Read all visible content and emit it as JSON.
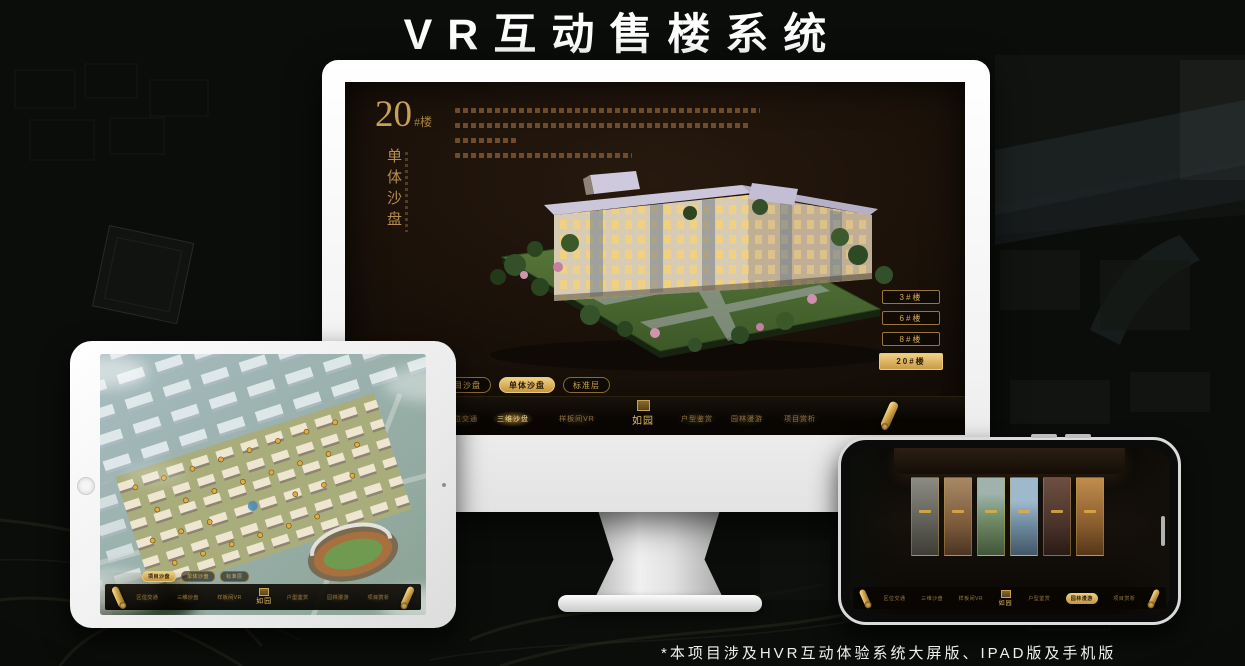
{
  "page": {
    "title": "VR互动售楼系统",
    "footnote": "*本项目涉及HVR互动体验系统大屏版、IPAD版及手机版"
  },
  "brand": {
    "logo_text": "如园"
  },
  "nav": {
    "items": [
      {
        "label": "区位交通"
      },
      {
        "label": "三维沙盘"
      },
      {
        "label": "样板间VR"
      },
      {
        "label": "户型鉴赏"
      },
      {
        "label": "园林漫游"
      },
      {
        "label": "项目赏析"
      }
    ]
  },
  "sub_tabs": [
    {
      "label": "项目沙盘"
    },
    {
      "label": "单体沙盘"
    },
    {
      "label": "标准层"
    }
  ],
  "desktop": {
    "unit_number": "20",
    "unit_suffix": "#楼",
    "unit_subtitle": "单体沙盘",
    "floor_buttons": [
      {
        "label": "3#楼"
      },
      {
        "label": "6#楼"
      },
      {
        "label": "8#楼"
      },
      {
        "label": "20#楼"
      }
    ],
    "selected_floor": "20#楼",
    "selected_sub_tab": "单体沙盘",
    "selected_nav": "三维沙盘"
  },
  "tablet": {
    "selected_sub_tab": "项目沙盘"
  },
  "phone": {
    "selected_nav": "园林漫游"
  },
  "colors": {
    "gold": "#d4a94e",
    "gold_bright": "#f0d083",
    "screen_bg": "#17100a",
    "nav_bg": "#0a0703",
    "white": "#ffffff"
  }
}
